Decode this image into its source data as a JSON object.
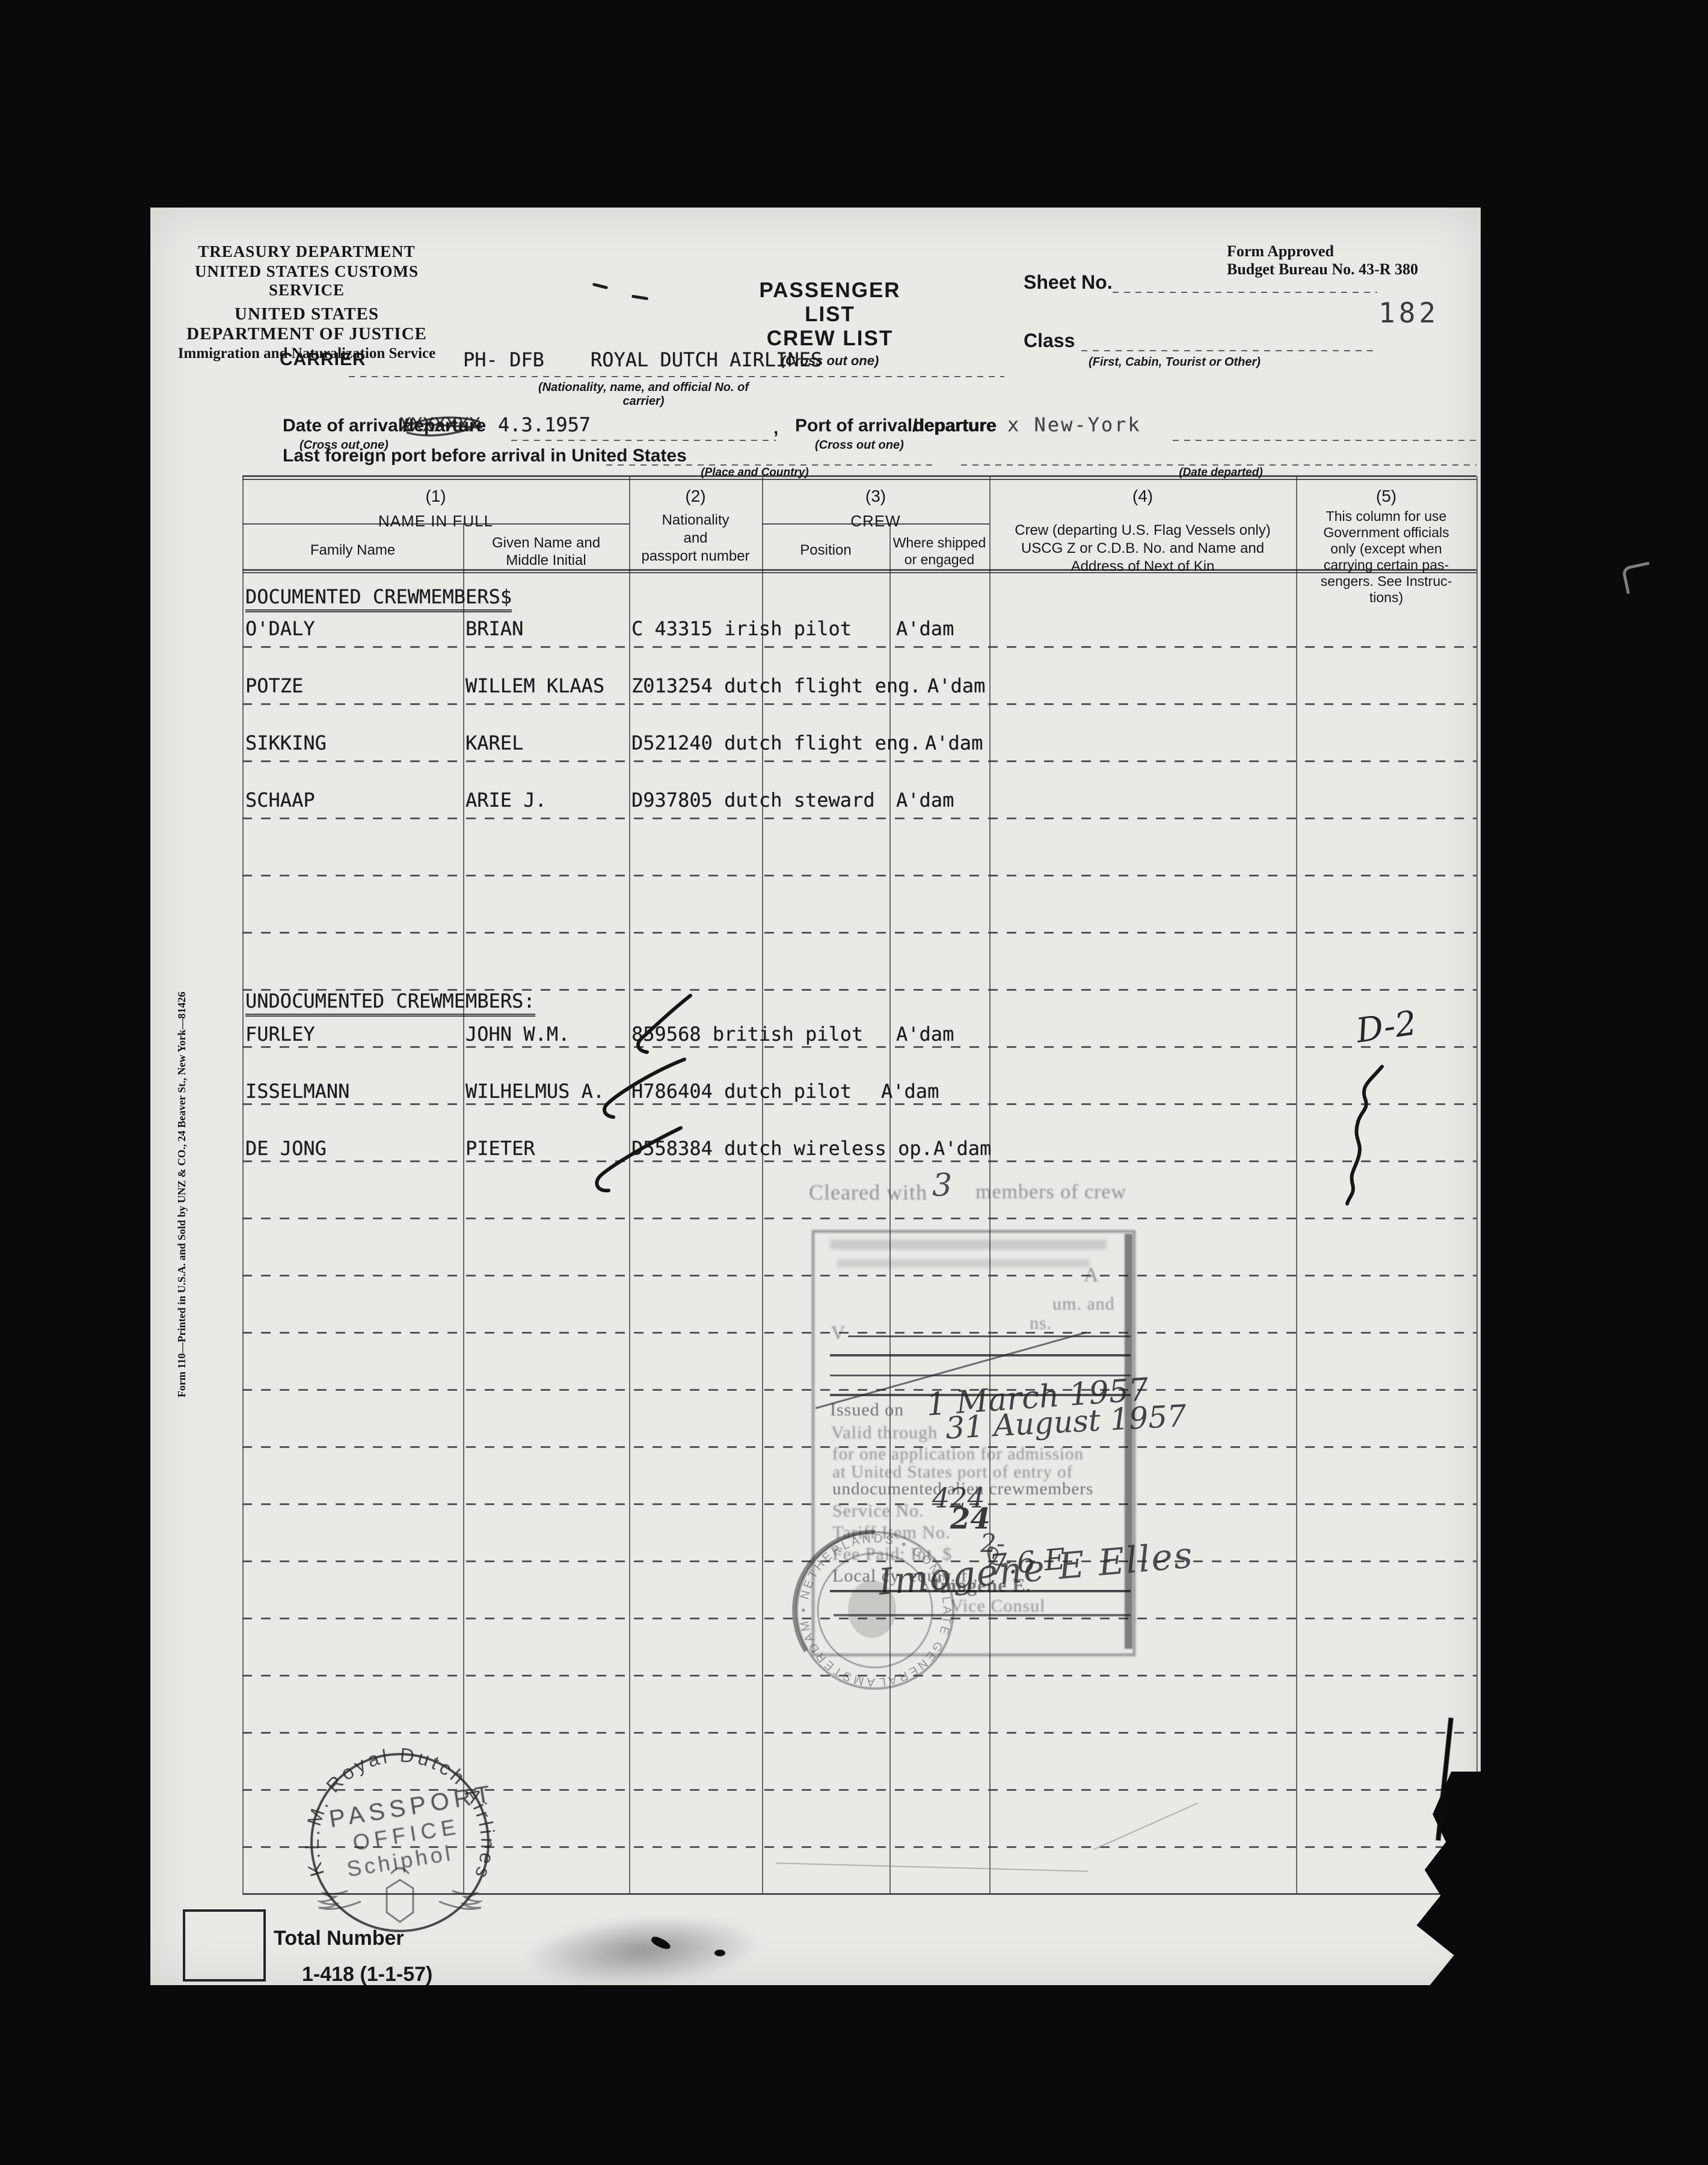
{
  "form": {
    "agency_line1": "TREASURY DEPARTMENT",
    "agency_line2": "UNITED STATES CUSTOMS SERVICE",
    "agency_line3": "UNITED STATES DEPARTMENT OF JUSTICE",
    "agency_line4": "Immigration and Naturalization Service",
    "approved_line1": "Form Approved",
    "approved_line2": "Budget Bureau No. 43-R 380",
    "title_passenger": "PASSENGER LIST",
    "title_crew": "CREW LIST",
    "title_note": "(Cross out one)",
    "sheet_label": "Sheet No.",
    "sheet_page_stamp": "182",
    "class_label": "Class",
    "class_note": "(First, Cabin, Tourist or Other)",
    "carrier_label": "CARRIER",
    "carrier_value": "PH- DFB    ROYAL DUTCH AIRLINES",
    "carrier_note": "(Nationality, name, and official No. of carrier)",
    "date_label": "Date of arrival/",
    "date_struck": "departure",
    "date_overstrike": "XXXXXXX",
    "date_value": "4.3.1957",
    "comma": ",",
    "crossout_note": "(Cross out one)",
    "port_label": "Port of arrival/",
    "port_struck": "departure",
    "port_value": "x New-York",
    "foreign_port_label": "Last foreign port before arrival in United States",
    "place_note": "(Place and Country)",
    "date_departed_note": "(Date departed)",
    "printer_note": "Form 110—Printed in U.S.A. and Sold by UNZ & CO., 24 Beaver St., New York—81426",
    "total_label": "Total Number",
    "form_code": "1-418 (1-1-57)"
  },
  "table": {
    "c1_no": "(1)",
    "c1_title": "NAME IN FULL",
    "c1a": "Family Name",
    "c1b": "Given Name and\nMiddle Initial",
    "c2_no": "(2)",
    "c2_title": "Nationality\nand\npassport number",
    "c3_no": "(3)",
    "c3_title": "CREW",
    "c3a": "Position",
    "c3b": "Where shipped\nor engaged",
    "c4_no": "(4)",
    "c4_title": "Crew (departing U.S. Flag Vessels only)\nUSCG Z or C.D.B. No. and Name and\nAddress of Next of Kin",
    "c5_no": "(5)",
    "c5_note": "This column for use\nGovernment officials\nonly (except when\ncarrying certain pas-\nsengers. See Instruc-\ntions)"
  },
  "crew": {
    "documented_header": "DOCUMENTED CREWMEMBERS$",
    "undocumented_header": "UNDOCUMENTED CREWMEMBERS:",
    "rows": [
      {
        "family": "O'DALY",
        "given": "BRIAN",
        "document": "C 43315 irish pilot",
        "place": "A'dam"
      },
      {
        "family": "POTZE",
        "given": "WILLEM KLAAS",
        "document": "Z013254 dutch flight eng.",
        "place": "A'dam"
      },
      {
        "family": "SIKKING",
        "given": "KAREL",
        "document": "D521240 dutch flight eng.",
        "place": "A'dam"
      },
      {
        "family": "SCHAAP",
        "given": "ARIE J.",
        "document": "D937805 dutch steward",
        "place": "A'dam"
      },
      {
        "family": "FURLEY",
        "given": "JOHN W.M.",
        "document": "859568 british pilot",
        "place": "A'dam"
      },
      {
        "family": "ISSELMANN",
        "given": "WILHELMUS A.",
        "document": "H786404 dutch pilot",
        "place": "A'dam"
      },
      {
        "family": "DE JONG",
        "given": "PIETER",
        "document": "D558384 dutch wireless op.",
        "place": "A'dam"
      }
    ],
    "official_mark": "D-2"
  },
  "stamps": {
    "cleared_prefix": "Cleared with",
    "cleared_count": "3",
    "cleared_suffix": "members of crew",
    "visa": {
      "fragment1": "A",
      "fragment2": "um. and",
      "fragment3": "ns.",
      "fragment4": "V",
      "issued_label": "Issued on",
      "issued_value": "1 March 1957",
      "valid_label": "Valid through",
      "valid_value": "31 August 1957",
      "purpose1": "for one application for admission",
      "purpose2": "at United States port of entry of",
      "purpose3": "undocumented alien crewmembers",
      "service_label": "Service No.",
      "service_value": "424",
      "tariff_label": "Tariff Item No.",
      "tariff_value": "24",
      "fee_label": "Fee Paid: Int. $",
      "fee_value": "2-",
      "local_label": "Local cy. equiv. fl.",
      "local_value": "7.6 E",
      "signature": "Imogene E Elles",
      "signer_name": "Imogene E.",
      "signer_title": "Vice Consul"
    },
    "consulate_ring": "AMSTERDAM • NETHERLANDS • CONSULATE GENERAL U.S.A. •",
    "klm_ring": "K.L.M. Royal Dutch Airlines",
    "klm_line1": "PASSPORT",
    "klm_line2": "OFFICE",
    "klm_line3": "Schiphol"
  }
}
